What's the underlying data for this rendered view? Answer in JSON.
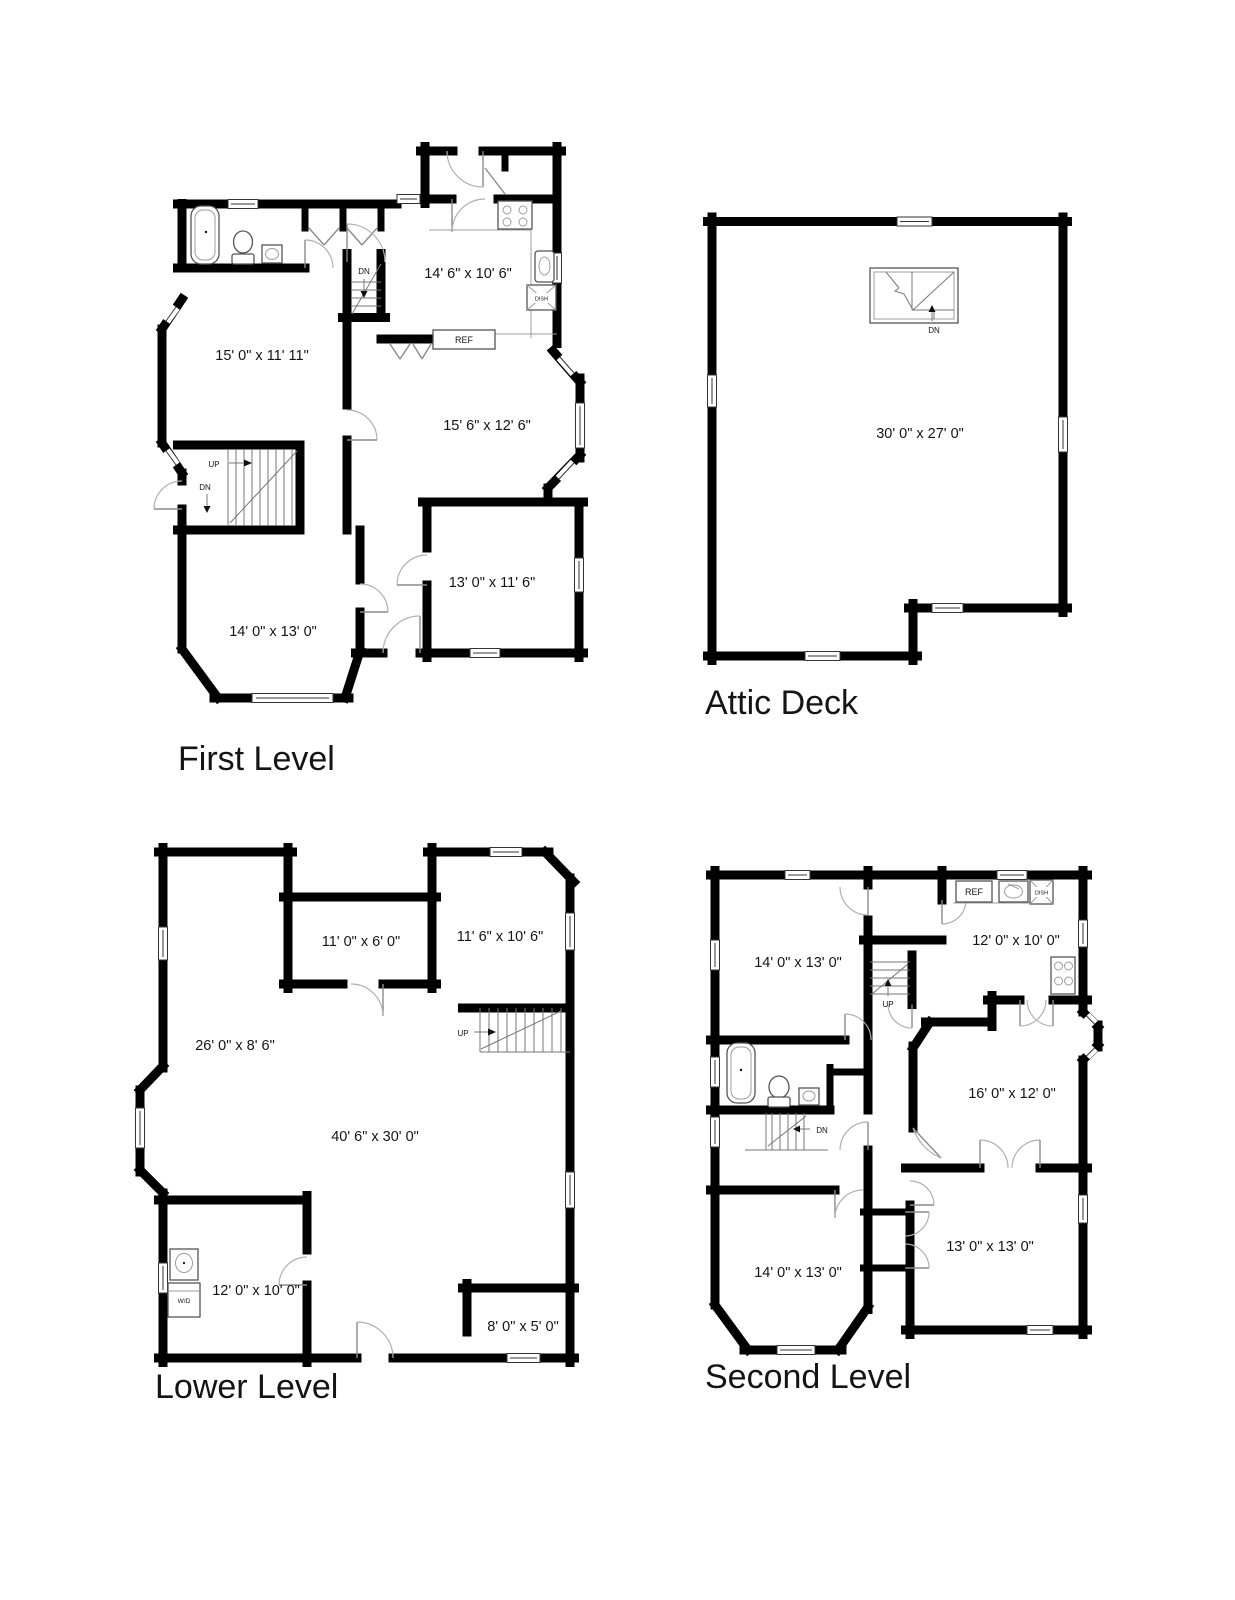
{
  "page": {
    "background": "#ffffff",
    "wall_color": "#000000"
  },
  "plans": {
    "first": {
      "title": "First Level",
      "rooms": {
        "kitchen": "14' 6\" x 10' 6\"",
        "living": "15' 0\" x 11' 11\"",
        "dining": "15' 6\" x 12' 6\"",
        "den": "13' 0\" x 11' 6\"",
        "family": "14' 0\" x 13' 0\""
      },
      "fixtures": {
        "ref": "REF",
        "dish": "DISH"
      },
      "stairs": {
        "dn_center": "DN",
        "up_left": "UP",
        "dn_left": "DN"
      }
    },
    "attic": {
      "title": "Attic Deck",
      "rooms": {
        "deck": "30' 0\" x 27' 0\""
      },
      "stairs": {
        "dn": "DN"
      }
    },
    "lower": {
      "title": "Lower Level",
      "rooms": {
        "storage": "11' 0\" x 6' 0\"",
        "rec": "11' 6\" x 10' 6\"",
        "side": "26' 0\" x 8' 6\"",
        "main": "40' 6\" x 30' 0\"",
        "laundry": "12' 0\" x 10' 0\"",
        "nook": "8' 0\" x 5' 0\""
      },
      "fixtures": {
        "wd": "W/D"
      },
      "stairs": {
        "up": "UP"
      }
    },
    "second": {
      "title": "Second Level",
      "rooms": {
        "bed1": "14' 0\" x 13' 0\"",
        "kitchen": "12' 0\" x 10' 0\"",
        "master": "16' 0\" x 12' 0\"",
        "bed3": "13' 0\" x 13' 0\"",
        "bed4": "14' 0\" x 13' 0\""
      },
      "fixtures": {
        "ref": "REF",
        "dish": "DISH"
      },
      "stairs": {
        "up": "UP",
        "dn": "DN"
      }
    }
  }
}
